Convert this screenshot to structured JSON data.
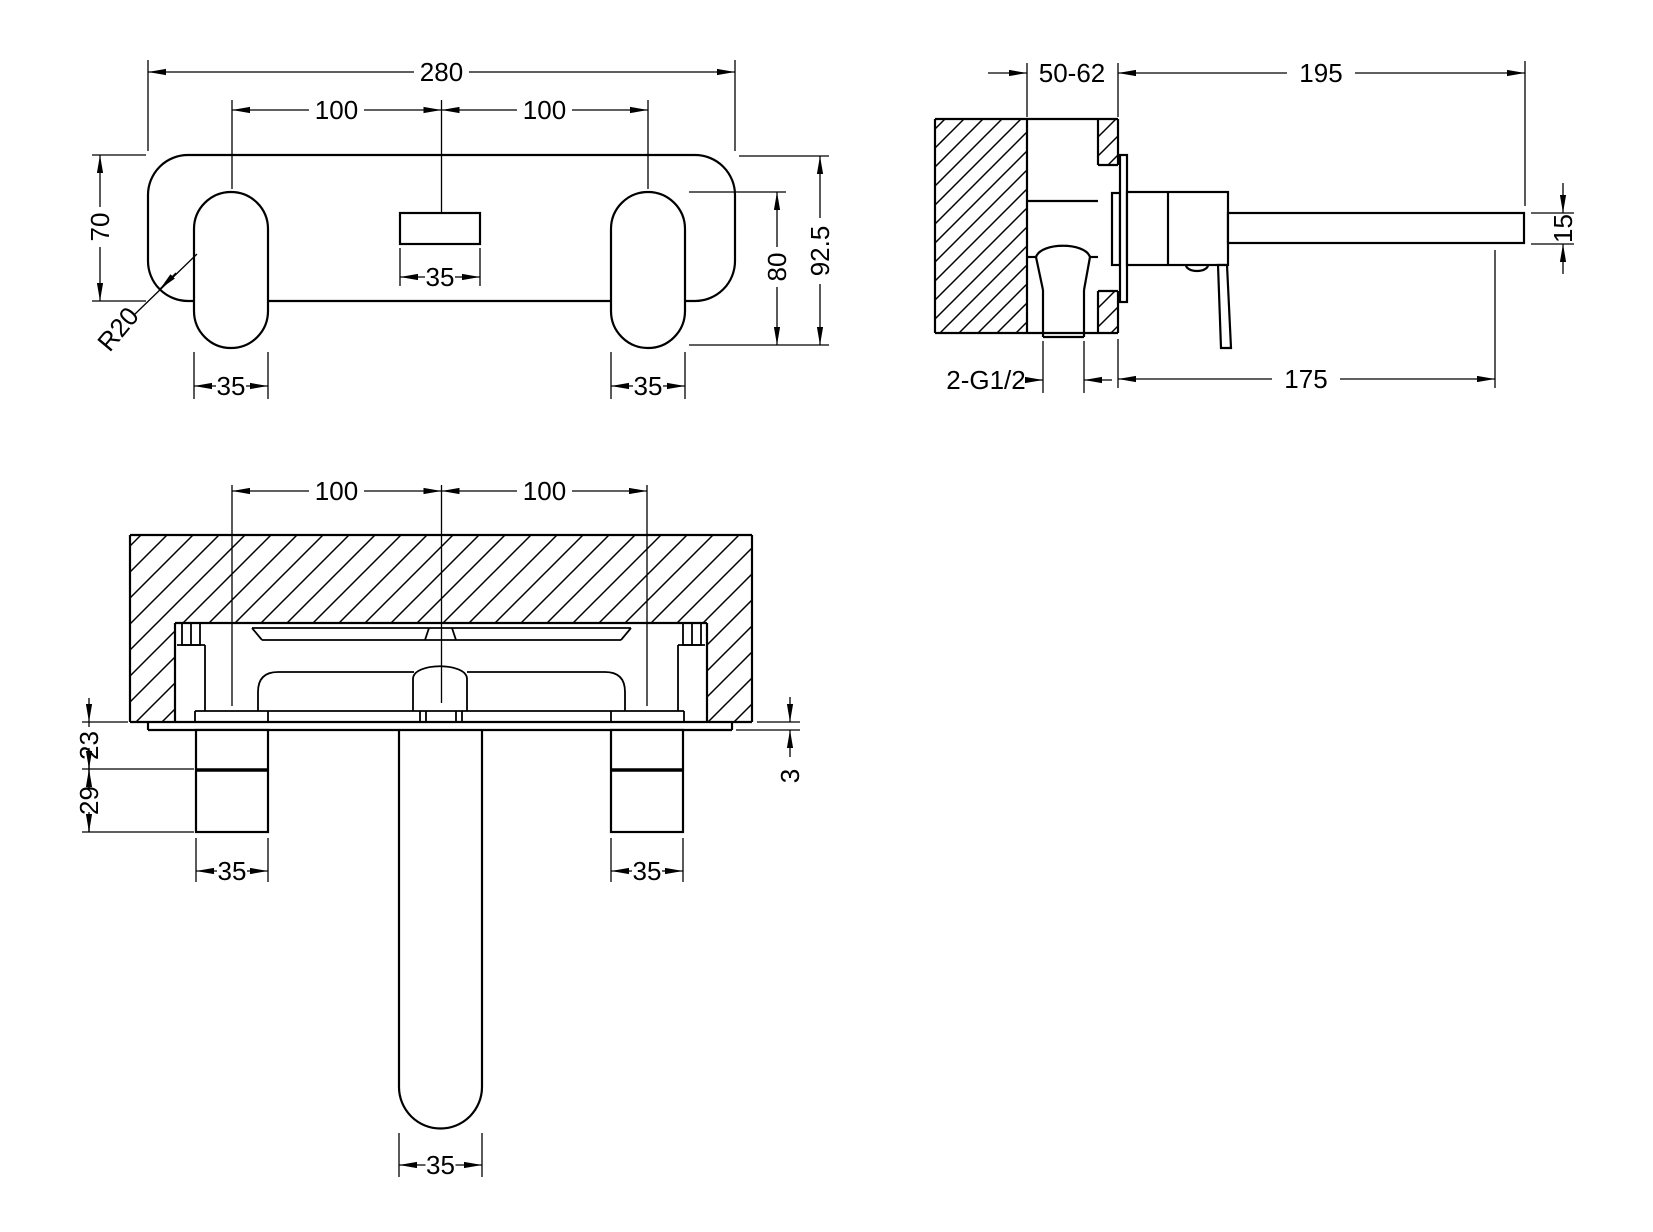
{
  "drawing": {
    "type": "technical-dimension-drawing",
    "subject": "wall-mounted-3-hole-basin-mixer-tap",
    "colors": {
      "line": "#000000",
      "background": "#ffffff"
    },
    "views": {
      "front": {
        "name": "front-view",
        "dims": {
          "overall_width": "280",
          "pitch_left": "100",
          "pitch_right": "100",
          "plate_height": "70",
          "corner_radius": "R20",
          "handle_width_left": "35",
          "spout_width": "35",
          "handle_width_right": "35",
          "handle_drop": "80",
          "overall_drop": "92.5"
        }
      },
      "side": {
        "name": "side-section-view",
        "dims": {
          "recess_depth": "50-62",
          "spout_reach": "195",
          "spout_diameter": "15",
          "outlet_projection": "175",
          "inlet_connection": "2-G1/2"
        }
      },
      "plan": {
        "name": "plan-section-view",
        "dims": {
          "pitch_left": "100",
          "pitch_right": "100",
          "plate_standoff": "23",
          "connector_depth": "29",
          "plate_thickness": "3",
          "handle_width_left": "35",
          "handle_width_right": "35",
          "spout_width": "35"
        }
      }
    }
  }
}
